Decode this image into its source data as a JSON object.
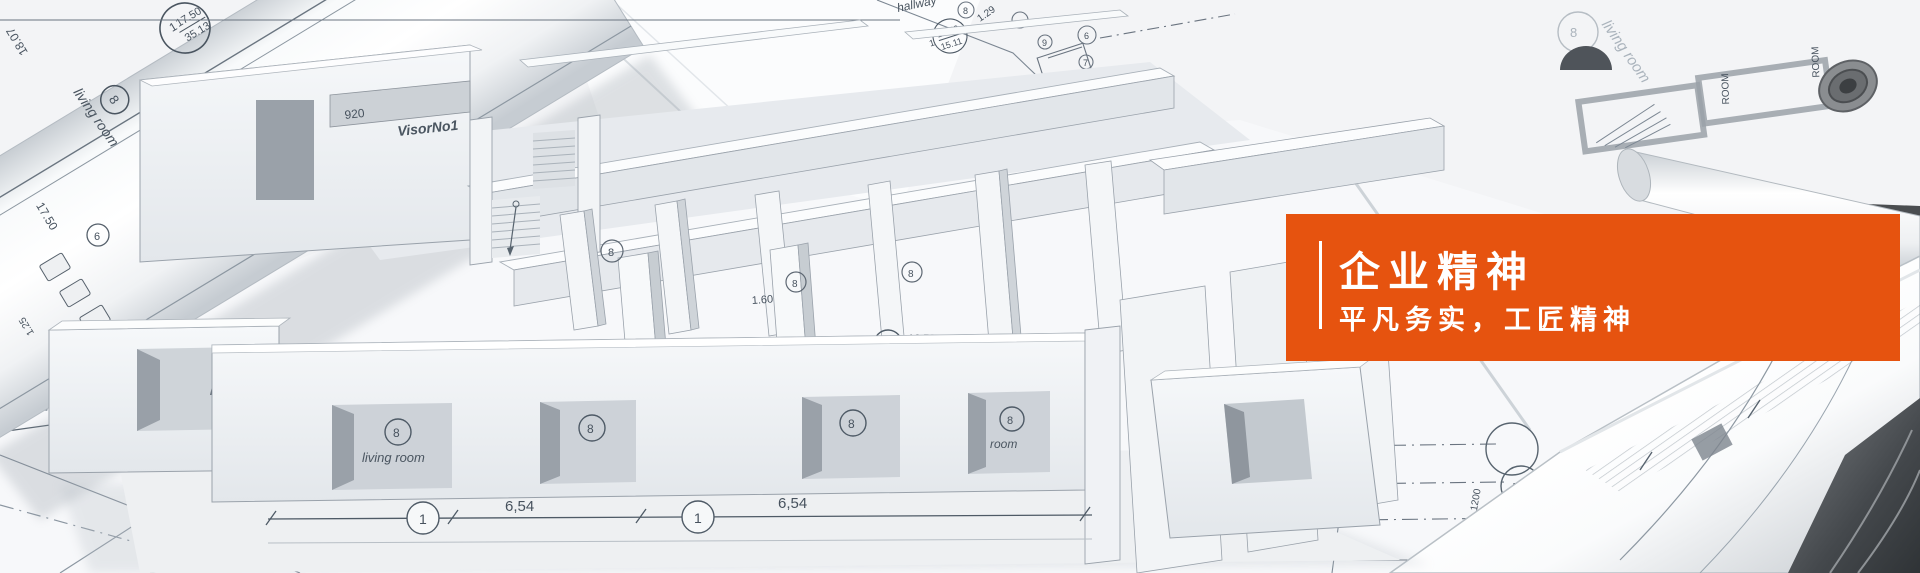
{
  "theme": {
    "accent_color": "#E6530F",
    "card_text_color": "#FFFFFF",
    "line_color": "#5C6B7A"
  },
  "card": {
    "title": "企业精神",
    "subtitle": "平凡务实，工匠精神"
  },
  "scene": {
    "labels": {
      "living_room": "living room",
      "living_partial": "livin",
      "kitchen_partial": "chen",
      "hallway": "hallway",
      "room": "room",
      "visor": "VisorNo1",
      "room_sheet": "ROOM"
    },
    "dims": {
      "d1750": "17.50",
      "d3513": "35.13",
      "d1250": "12.50",
      "d1511": "15.11",
      "d1659": "16.59",
      "d654": "6,54",
      "d160": "1.60",
      "d129": "1.29",
      "d125": "1.25",
      "d84": "8.4",
      "d1807": "18.07",
      "d920": "920",
      "d5550": "5550",
      "d6300": "6,300",
      "d1200": "1200"
    },
    "markers": {
      "m1": "1",
      "m6": "6",
      "m7": "7",
      "m8": "8",
      "m9": "9",
      "ac": "Ac",
      "b": "B"
    }
  }
}
